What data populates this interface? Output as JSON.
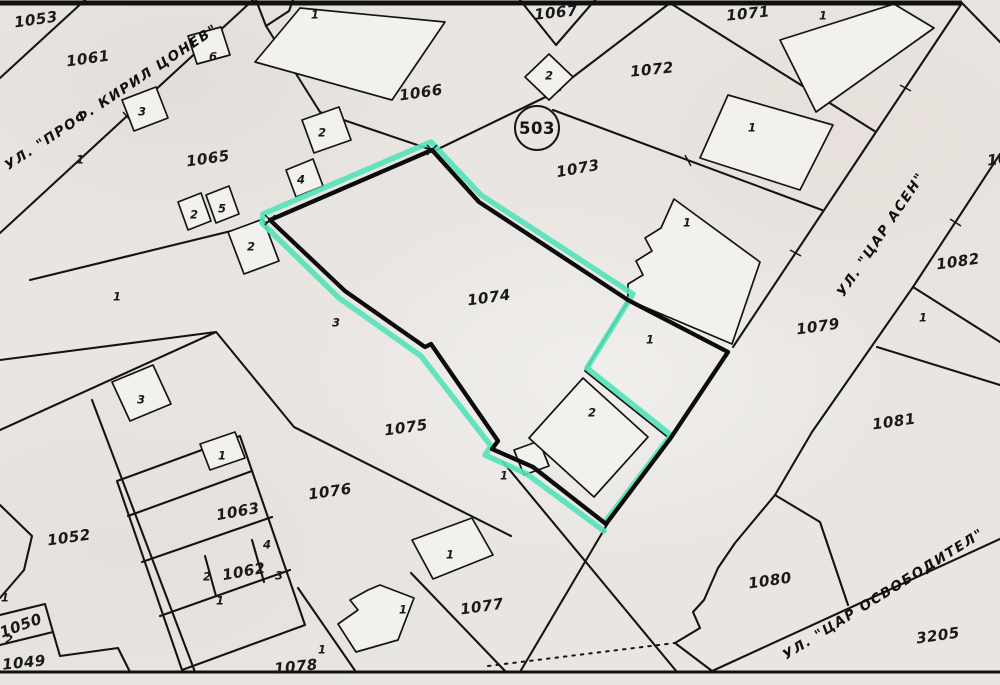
{
  "map": {
    "background": "#e9e6e2",
    "line_color": "#141414",
    "highlight_color": "#52e2ba",
    "building_fill": "#f3f1ee",
    "highlighted_parcel": "1074"
  },
  "circle_badge": {
    "label": "503"
  },
  "streets": [
    {
      "name": "УЛ. \"ПРОФ. КИРИЛ ЦОНЕВ\"",
      "x": 112,
      "y": 98,
      "r": -33.5
    },
    {
      "name": "УЛ. \"ЦАР АСЕН\"",
      "x": 882,
      "y": 235,
      "r": -56
    },
    {
      "name": "УЛ. \"ЦАР ОСВОБОДИТЕЛ\"",
      "x": 884,
      "y": 595,
      "r": -32
    }
  ],
  "parcel_labels": [
    {
      "t": "1053",
      "x": 36,
      "y": 20,
      "r": -8
    },
    {
      "t": "1061",
      "x": 88,
      "y": 59,
      "r": -8
    },
    {
      "t": "1065",
      "x": 208,
      "y": 159,
      "r": -8
    },
    {
      "t": "1066",
      "x": 421,
      "y": 93,
      "r": -8
    },
    {
      "t": "1067",
      "x": 556,
      "y": 13,
      "r": -6
    },
    {
      "t": "1071",
      "x": 748,
      "y": 14,
      "r": -6
    },
    {
      "t": "1072",
      "x": 652,
      "y": 70,
      "r": -6
    },
    {
      "t": "1073",
      "x": 578,
      "y": 169,
      "r": -10
    },
    {
      "t": "1074",
      "x": 489,
      "y": 298,
      "r": -8
    },
    {
      "t": "1075",
      "x": 406,
      "y": 428,
      "r": -8
    },
    {
      "t": "1076",
      "x": 330,
      "y": 492,
      "r": -8
    },
    {
      "t": "1077",
      "x": 482,
      "y": 607,
      "r": -8
    },
    {
      "t": "1078",
      "x": 296,
      "y": 667,
      "r": -6
    },
    {
      "t": "1079",
      "x": 818,
      "y": 327,
      "r": -8
    },
    {
      "t": "1080",
      "x": 770,
      "y": 581,
      "r": -8
    },
    {
      "t": "1081",
      "x": 894,
      "y": 422,
      "r": -8
    },
    {
      "t": "1082",
      "x": 958,
      "y": 262,
      "r": -8
    },
    {
      "t": "1052",
      "x": 69,
      "y": 538,
      "r": -8
    },
    {
      "t": "1063",
      "x": 238,
      "y": 512,
      "r": -10
    },
    {
      "t": "1062",
      "x": 244,
      "y": 572,
      "r": -10
    },
    {
      "t": "1049",
      "x": 24,
      "y": 663,
      "r": -6
    },
    {
      "t": "1050",
      "x": 21,
      "y": 626,
      "r": -20
    },
    {
      "t": "3205",
      "x": 938,
      "y": 636,
      "r": -8
    },
    {
      "t": "10",
      "x": 998,
      "y": 160,
      "r": -6
    }
  ],
  "building_numbers": [
    {
      "t": "6",
      "x": 213,
      "y": 57
    },
    {
      "t": "3",
      "x": 142,
      "y": 112
    },
    {
      "t": "1",
      "x": 80,
      "y": 160
    },
    {
      "t": "2",
      "x": 194,
      "y": 215
    },
    {
      "t": "5",
      "x": 222,
      "y": 209
    },
    {
      "t": "2",
      "x": 251,
      "y": 247
    },
    {
      "t": "1",
      "x": 117,
      "y": 297
    },
    {
      "t": "3",
      "x": 141,
      "y": 400
    },
    {
      "t": "2",
      "x": 322,
      "y": 133
    },
    {
      "t": "4",
      "x": 301,
      "y": 180
    },
    {
      "t": "3",
      "x": 336,
      "y": 323
    },
    {
      "t": "1",
      "x": 315,
      "y": 15
    },
    {
      "t": "2",
      "x": 549,
      "y": 76
    },
    {
      "t": "1",
      "x": 823,
      "y": 16
    },
    {
      "t": "1",
      "x": 752,
      "y": 128
    },
    {
      "t": "1",
      "x": 687,
      "y": 223
    },
    {
      "t": "1",
      "x": 650,
      "y": 340
    },
    {
      "t": "2",
      "x": 592,
      "y": 413
    },
    {
      "t": "1",
      "x": 923,
      "y": 318
    },
    {
      "t": "1",
      "x": 222,
      "y": 456
    },
    {
      "t": "4",
      "x": 267,
      "y": 545
    },
    {
      "t": "2",
      "x": 207,
      "y": 577
    },
    {
      "t": "3",
      "x": 279,
      "y": 576
    },
    {
      "t": "1",
      "x": 220,
      "y": 601
    },
    {
      "t": "1",
      "x": 5,
      "y": 598
    },
    {
      "t": "2",
      "x": 9,
      "y": 640
    },
    {
      "t": "1",
      "x": 504,
      "y": 476
    },
    {
      "t": "1",
      "x": 450,
      "y": 555
    },
    {
      "t": "1",
      "x": 403,
      "y": 610
    },
    {
      "t": "1",
      "x": 322,
      "y": 650
    }
  ]
}
